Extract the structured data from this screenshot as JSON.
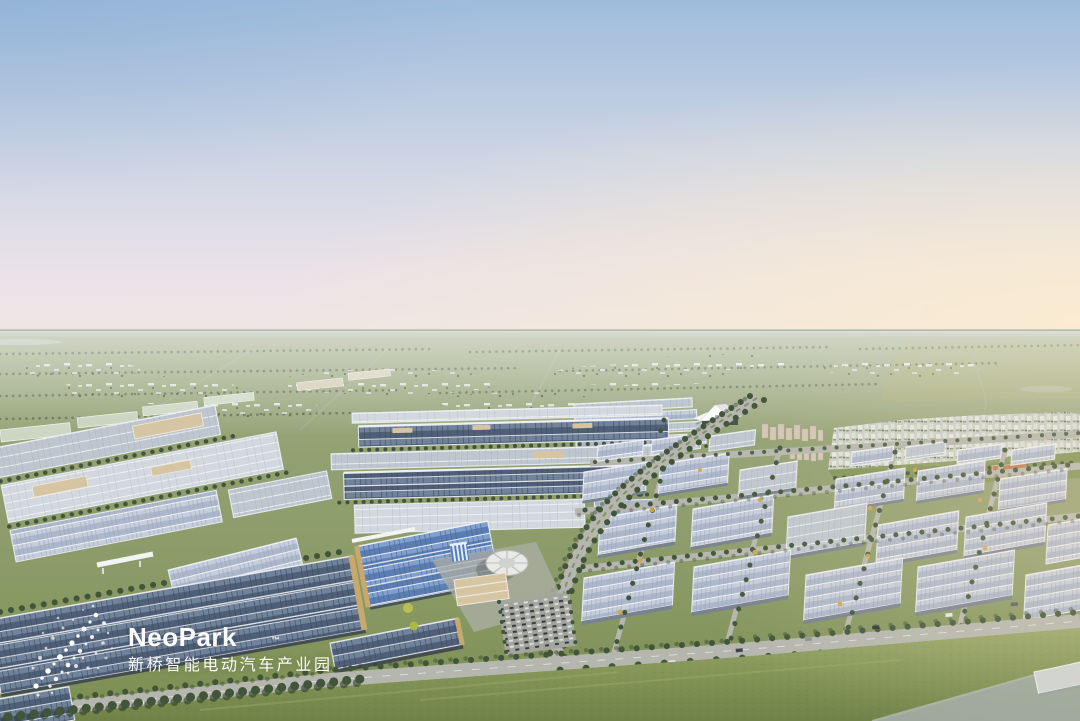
{
  "logo": {
    "brand": "NeoPark",
    "trademark": "™",
    "subtitle_zh": "新桥智能电动汽车产业园",
    "icon": "dot-constellation-logo"
  },
  "colors": {
    "sky_top": "#9fbcdc",
    "sky_mid": "#ccd4e4",
    "sky_low": "#e9e2e8",
    "sky_warm": "#fbeccf",
    "horizon_haze": "#b9c2b2",
    "field_far": "#a6af8e",
    "field_mid": "#8a9a66",
    "field_near": "#7a8e50",
    "grass": "#8a9c5e",
    "lawn": "#7d9150",
    "solar_dark": "#4e5f77",
    "solar_dark_hi": "#71839b",
    "solar_blue": "#5c7db0",
    "solar_blue_hi": "#82a0cd",
    "solar_lav": "#adb7cb",
    "solar_lav_hi": "#c6cedd",
    "roof_grey": "#bec7d0",
    "roof_light": "#d2d8de",
    "roof_tan": "#d6c5a2",
    "wall_tan": "#c8a96d",
    "frame_white": "#edf0f3",
    "tree": "#42553a",
    "tree_shadow": "#2e4028",
    "tree_gold": "#d2a64b",
    "road": "#b5b7af",
    "city": "#dfe3e0",
    "city_shadow": "#96a090",
    "campus_orange": "#bf7b48",
    "water": "#9da79b",
    "dark_base": "#39424e",
    "white": "#ffffff"
  }
}
